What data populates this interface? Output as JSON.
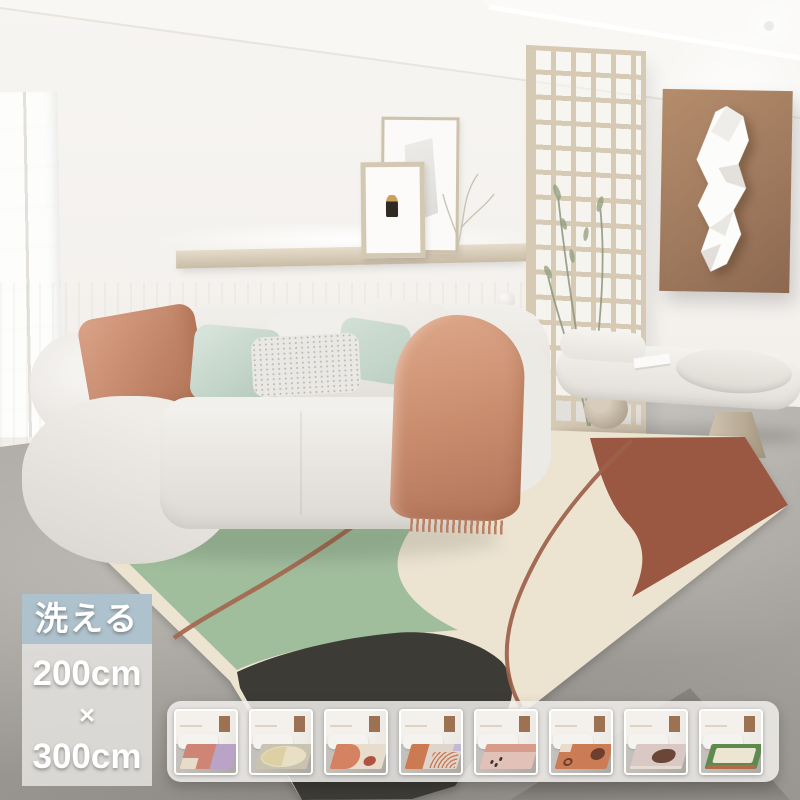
{
  "page": {
    "type": "product-photo",
    "subject": "washable living-room rug in interior scene"
  },
  "overlay": {
    "washable_badge": {
      "text": "洗える",
      "bg_color": "#aec2cd",
      "text_color": "#ffffff"
    },
    "size_panel": {
      "width_label": "200cm",
      "separator": "×",
      "length_label": "300cm",
      "bg_color": "rgba(228,227,223,0.85)",
      "text_color": "#ffffff"
    }
  },
  "main_rug": {
    "colors": {
      "cream": "#ece4d1",
      "green": "#a0bd9c",
      "rust": "#9a5742",
      "charcoal": "#3d3b36",
      "line": "#a4674e",
      "line2": "#9c6049"
    }
  },
  "scene": {
    "wall_color": "#f5f3f0",
    "floor_color": "#aaa7a2",
    "art_panel_color": "#a27b5e",
    "sofa_color": "#eceae5",
    "throw_color": "#c88b6c",
    "pillow_colors": [
      "#c98d70",
      "#c2d4c7",
      "#eae8e4"
    ],
    "furniture": [
      "sofa",
      "cushions",
      "throw-blanket",
      "floating-shelf",
      "picture-frames",
      "lattice-screen",
      "wall-art-panel",
      "paper-sculpture",
      "side-table",
      "bench",
      "sphere-leg",
      "plant"
    ]
  },
  "thumbnails": [
    {
      "name": "variant-1-pink-patchwork",
      "pattern": "patchwork",
      "colors": [
        "#cf8576",
        "#b9a3c6",
        "#e7dbca"
      ]
    },
    {
      "name": "variant-2-cream-oval",
      "pattern": "oval",
      "colors": [
        "#c9c4b0",
        "#e8dfc4",
        "#ddd0a4"
      ]
    },
    {
      "name": "variant-3-coral-circle",
      "pattern": "waves-circle",
      "colors": [
        "#e8ddcc",
        "#d58263",
        "#b05441"
      ]
    },
    {
      "name": "variant-4-orange-arcs",
      "pattern": "arcs",
      "colors": [
        "#e0d5cc",
        "#cc7a52",
        "#c4b8d4"
      ]
    },
    {
      "name": "variant-5-blush-figures",
      "pattern": "figures",
      "colors": [
        "#e2c2b8",
        "#d89c8a",
        "#3a3632"
      ]
    },
    {
      "name": "variant-6-terracotta-circles",
      "pattern": "circles",
      "colors": [
        "#cc7c55",
        "#6e3f2e",
        "#e8dccc"
      ]
    },
    {
      "name": "variant-7-mauve-blob",
      "pattern": "blob",
      "colors": [
        "#d9c8c3",
        "#6b4636",
        "#e5dcd4"
      ]
    },
    {
      "name": "variant-8-green-border",
      "pattern": "border",
      "colors": [
        "#5e8a4e",
        "#ece5d2",
        "#b56a4a"
      ]
    }
  ]
}
